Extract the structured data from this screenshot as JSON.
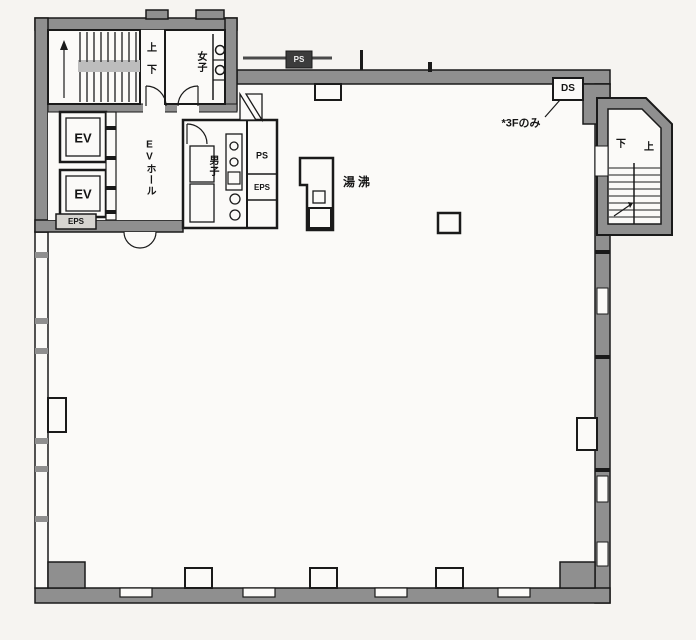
{
  "plan": {
    "labels": {
      "left_stair_up": "上",
      "left_stair_down": "下",
      "womens_room": "女子",
      "elevator_1": "EV",
      "elevator_2": "EV",
      "ev_hall": "EVホール",
      "eps_box_left": "EPS",
      "mens_room": "男子",
      "ps_shaft": "PS",
      "eps_shaft": "EPS",
      "kitchenette": "湯沸",
      "ps_top": "PS",
      "ds_box": "DS",
      "annotation_3f": "*3Fのみ",
      "right_stair_down": "下",
      "right_stair_up": "上"
    },
    "colors": {
      "line": "#1a1a1a",
      "wall_fill": "#8f8f8f",
      "paper": "#f6f4f1",
      "interior": "#fbfaf8",
      "stair_band": "#bdbdbd"
    }
  }
}
